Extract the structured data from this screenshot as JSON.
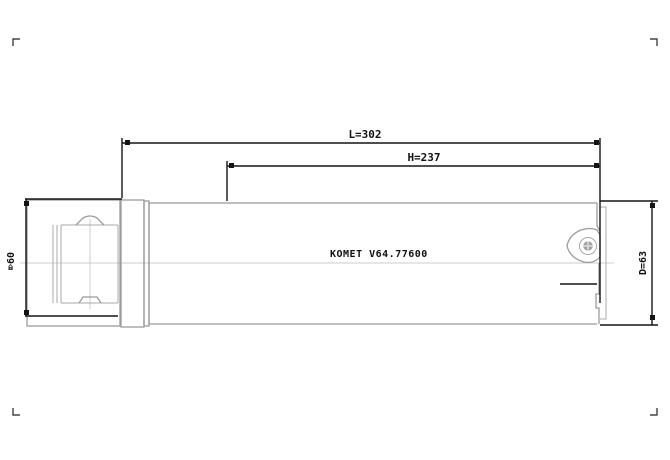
{
  "drawing": {
    "dimensions": {
      "length_label": "L=302",
      "head_label": "H=237",
      "left_diameter_label": "⌦60",
      "right_diameter_label": "D=63"
    },
    "body_marking": "KOMET V64.77600",
    "colors": {
      "geometry_line": "#9b9b9b",
      "centerline": "#cccccc",
      "dimension_line": "#141414",
      "text": "#111111",
      "background": "#ffffff"
    }
  }
}
